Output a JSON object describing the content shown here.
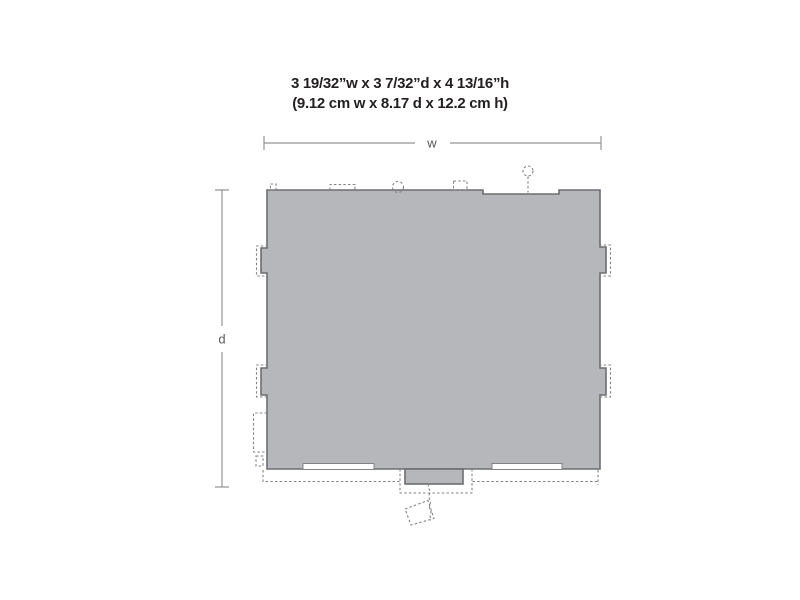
{
  "diagram": {
    "dimensions_imperial": "3 19/32”w x 3 7/32”d x 4 13/16”h",
    "dimensions_metric": "(9.12 cm w x 8.17 d x 12.2 cm h)",
    "width_label": "w",
    "depth_label": "d"
  },
  "colors": {
    "background": "#ffffff",
    "title_text": "#231f20",
    "label_text": "#58595b",
    "dimension_line": "#939598",
    "body_fill": "#b5b7ba",
    "body_stroke": "#6d6e71",
    "dashed_line": "#808285"
  }
}
